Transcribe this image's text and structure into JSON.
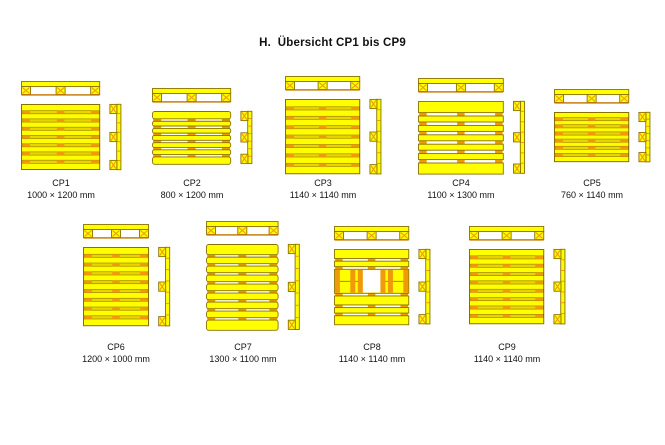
{
  "page": {
    "title": "H.  Übersicht CP1 bis CP9",
    "background": "#FFFFFF"
  },
  "colors": {
    "board_yellow": "#FFFF00",
    "separator_yellow": "#E9D400",
    "outline_olive": "#8A7000",
    "mark_orange": "#F0990A",
    "rail_brown": "#C37500",
    "gap_white": "#FFFFFF",
    "text": "#111111"
  },
  "scale_px_per_mm": 0.066,
  "rows": [
    {
      "center_y": 137,
      "label_y": 177
    },
    {
      "center_y": 287,
      "label_y": 341
    }
  ],
  "pallets": [
    {
      "id": "CP1",
      "dims": "1000 × 1200 mm",
      "width_mm": 1200,
      "depth_mm": 1000,
      "style": "slats",
      "boards": 8,
      "wide_ends": false,
      "row": 0,
      "center_x": 61
    },
    {
      "id": "CP2",
      "dims": "800 × 1200 mm",
      "width_mm": 1200,
      "depth_mm": 800,
      "style": "gaps",
      "boards": 7,
      "wide_ends": true,
      "row": 0,
      "center_x": 192
    },
    {
      "id": "CP3",
      "dims": "1140 × 1140 mm",
      "width_mm": 1140,
      "depth_mm": 1140,
      "style": "slats",
      "boards": 8,
      "wide_ends": false,
      "row": 0,
      "center_x": 323
    },
    {
      "id": "CP4",
      "dims": "1100 × 1300 mm",
      "width_mm": 1300,
      "depth_mm": 1100,
      "style": "blocks",
      "boards": 7,
      "wide_ends": true,
      "row": 0,
      "center_x": 461
    },
    {
      "id": "CP5",
      "dims": "760 × 1140 mm",
      "width_mm": 1140,
      "depth_mm": 760,
      "style": "slats",
      "boards": 7,
      "wide_ends": false,
      "row": 0,
      "center_x": 592
    },
    {
      "id": "CP6",
      "dims": "1200 × 1000 mm",
      "width_mm": 1000,
      "depth_mm": 1200,
      "style": "slats",
      "boards": 9,
      "wide_ends": false,
      "row": 1,
      "center_x": 116
    },
    {
      "id": "CP7",
      "dims": "1300 × 1100 mm",
      "width_mm": 1100,
      "depth_mm": 1300,
      "style": "gaps",
      "boards": 9,
      "wide_ends": true,
      "row": 1,
      "center_x": 243
    },
    {
      "id": "CP8",
      "dims": "1140 × 1140 mm",
      "width_mm": 1140,
      "depth_mm": 1140,
      "style": "window",
      "boards": 6,
      "wide_ends": true,
      "row": 1,
      "center_x": 372
    },
    {
      "id": "CP9",
      "dims": "1140 × 1140 mm",
      "width_mm": 1140,
      "depth_mm": 1140,
      "style": "slats",
      "boards": 9,
      "wide_ends": false,
      "row": 1,
      "center_x": 507
    }
  ]
}
